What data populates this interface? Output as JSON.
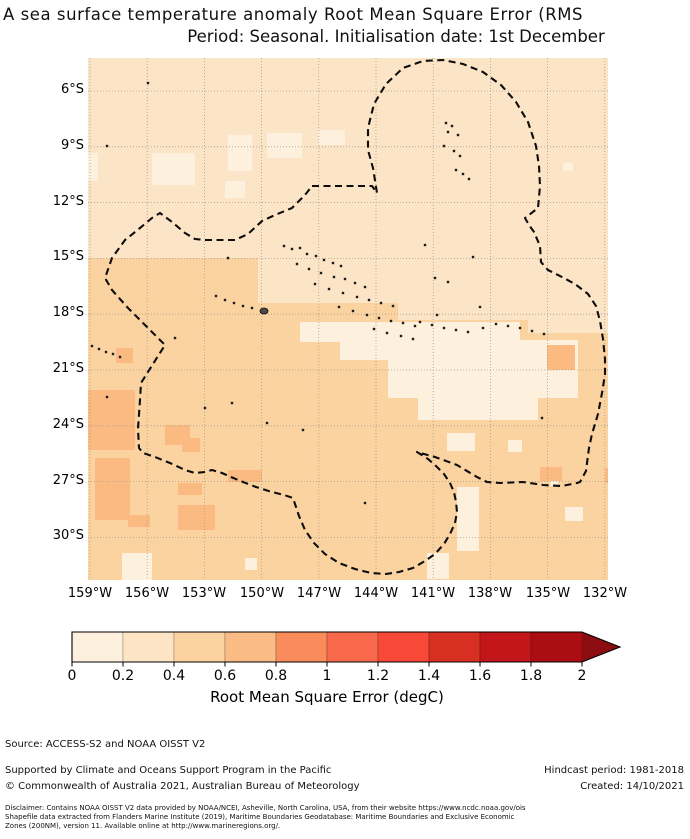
{
  "title": {
    "line1": "A sea surface temperature anomaly Root Mean Square Error (RMS",
    "line2": "Period: Seasonal. Initialisation date: 1st December"
  },
  "axes": {
    "y": [
      {
        "label": "6°S",
        "y": 91
      },
      {
        "label": "9°S",
        "y": 147
      },
      {
        "label": "12°S",
        "y": 203
      },
      {
        "label": "15°S",
        "y": 258
      },
      {
        "label": "18°S",
        "y": 314
      },
      {
        "label": "21°S",
        "y": 370
      },
      {
        "label": "24°S",
        "y": 426
      },
      {
        "label": "27°S",
        "y": 482
      },
      {
        "label": "30°S",
        "y": 537
      }
    ],
    "x": [
      {
        "label": "159°W",
        "x": 90
      },
      {
        "label": "156°W",
        "x": 147
      },
      {
        "label": "153°W",
        "x": 204
      },
      {
        "label": "150°W",
        "x": 262
      },
      {
        "label": "147°W",
        "x": 319
      },
      {
        "label": "144°W",
        "x": 376
      },
      {
        "label": "141°W",
        "x": 433
      },
      {
        "label": "138°W",
        "x": 490
      },
      {
        "label": "135°W",
        "x": 548
      },
      {
        "label": "132°W",
        "x": 605
      }
    ]
  },
  "colorbar": {
    "x": 72,
    "y": 2,
    "width": 510,
    "height": 30,
    "tip_x": 620,
    "segment_colors": [
      "#fdf0dc",
      "#fce4c4",
      "#fcd3a0",
      "#fbbb84",
      "#fa8c5c",
      "#f8684a",
      "#f74838",
      "#d72f21",
      "#c2161b",
      "#aa0e13"
    ],
    "arrow_color": "#8b0d11",
    "tick_labels": [
      "0",
      "0.2",
      "0.4",
      "0.6",
      "0.8",
      "1",
      "1.2",
      "1.4",
      "1.6",
      "1.8",
      "2"
    ],
    "label": "Root Mean Square Error (degC)"
  },
  "map": {
    "width": 520,
    "height": 522,
    "colors": {
      "base_north": "#fce4c6",
      "base_south": "#fbd3a1",
      "pale": "#fdf0dd",
      "dark": "#fbba82",
      "island": "#1c1c1c",
      "tahiti": "#4a4a4a",
      "grid": "#aa9d8b",
      "eez": "#0d0d0d"
    },
    "grid": {
      "vx": [
        2,
        59.2,
        116.4,
        173.6,
        230.8,
        288,
        345.2,
        402.4,
        459.6,
        516.8
      ],
      "hy": [
        33,
        88.8,
        144.6,
        200.4,
        256.2,
        312,
        367.8,
        423.6,
        479.4
      ]
    },
    "south_rects": [
      [
        0,
        200,
        170,
        322
      ],
      [
        170,
        245,
        140,
        277
      ],
      [
        310,
        262,
        130,
        260
      ],
      [
        440,
        275,
        80,
        247
      ]
    ],
    "pale_rects": [
      [
        64,
        95,
        43,
        32
      ],
      [
        140,
        77,
        24,
        36
      ],
      [
        179,
        75,
        35,
        25
      ],
      [
        230,
        72,
        27,
        15
      ],
      [
        137,
        123,
        20,
        17
      ],
      [
        0,
        95,
        10,
        28
      ],
      [
        212,
        264,
        46,
        20
      ],
      [
        252,
        264,
        180,
        38
      ],
      [
        300,
        282,
        190,
        58
      ],
      [
        330,
        330,
        120,
        32
      ],
      [
        369,
        429,
        22,
        64
      ],
      [
        359,
        375,
        28,
        18
      ],
      [
        420,
        382,
        14,
        12
      ],
      [
        477,
        449,
        18,
        14
      ],
      [
        339,
        495,
        22,
        26
      ],
      [
        34,
        495,
        30,
        27
      ],
      [
        157,
        500,
        12,
        12
      ],
      [
        462,
        422,
        8,
        6
      ],
      [
        475,
        105,
        10,
        8
      ]
    ],
    "dark_rects": [
      [
        0,
        332,
        47,
        60
      ],
      [
        7,
        400,
        35,
        62
      ],
      [
        90,
        425,
        24,
        12
      ],
      [
        90,
        447,
        37,
        25
      ],
      [
        40,
        457,
        22,
        12
      ],
      [
        77,
        367,
        25,
        20
      ],
      [
        140,
        412,
        34,
        12
      ],
      [
        452,
        409,
        22,
        14
      ],
      [
        459,
        287,
        28,
        25
      ],
      [
        94,
        380,
        18,
        14
      ],
      [
        28,
        290,
        17,
        15
      ],
      [
        517,
        410,
        3,
        15
      ]
    ],
    "eez_path": "M224,128 L284,128 L289,135 L285,110 L280,92 L280,70 L286,46 L298,26 L315,10 L335,3 L355,2 L375,6 L395,14 L413,27 L428,44 L440,64 L448,88 L451,108 L452,128 L450,150 L437,160 L441,167 L446,174 L452,188 L453,204 L460,212 L472,218 L487,226 L500,236 L508,248 L512,263 L515,281 L517,301 L517,316 L514,335 L510,356 L504,376 L501,390 L499,405 L498,413 L492,424 L489,425 L474,428 L455,427 L435,424 L412,425 L399,424 L389,419 L369,407 L347,399 L329,394 L340,401 L348,408 L356,416 L362,425 L366,434 L368,444 L369,454 L367,465 L362,476 L356,486 L347,496 L337,503 L325,510 L311,514 L298,516 L283,515 L267,511 L251,505 L237,496 L226,485 L217,472 L211,458 L207,446 L205,440 L196,437 L184,434 L168,429 L155,424 L143,419 L134,415 L124,412 L117,414 L107,415 L97,412 L82,405 L67,399 L55,395 L51,390 L50,371 L52,342 L53,325 L77,287 L52,262 L40,250 L24,232 L17,220 L24,200 L37,182 L52,170 L64,160 L72,155 L84,164 L97,175 L107,181 L117,182 L132,182 L147,182 L160,176 L174,163 L187,157 L204,150 L217,137 Z",
    "islands": [
      [
        60,
        25
      ],
      [
        19,
        88
      ],
      [
        140,
        200
      ],
      [
        358,
        65
      ],
      [
        364,
        68
      ],
      [
        360,
        74
      ],
      [
        370,
        77
      ],
      [
        356,
        88
      ],
      [
        366,
        93
      ],
      [
        372,
        98
      ],
      [
        368,
        112
      ],
      [
        375,
        116
      ],
      [
        381,
        121
      ],
      [
        196,
        188
      ],
      [
        204,
        191
      ],
      [
        212,
        190
      ],
      [
        219,
        196
      ],
      [
        228,
        198
      ],
      [
        236,
        202
      ],
      [
        245,
        205
      ],
      [
        253,
        208
      ],
      [
        209,
        206
      ],
      [
        221,
        211
      ],
      [
        233,
        215
      ],
      [
        246,
        219
      ],
      [
        257,
        221
      ],
      [
        267,
        225
      ],
      [
        277,
        229
      ],
      [
        227,
        226
      ],
      [
        241,
        231
      ],
      [
        255,
        235
      ],
      [
        269,
        239
      ],
      [
        281,
        242
      ],
      [
        293,
        245
      ],
      [
        305,
        248
      ],
      [
        251,
        249
      ],
      [
        265,
        253
      ],
      [
        279,
        257
      ],
      [
        291,
        260
      ],
      [
        303,
        263
      ],
      [
        315,
        265
      ],
      [
        327,
        268
      ],
      [
        286,
        271
      ],
      [
        299,
        275
      ],
      [
        313,
        278
      ],
      [
        325,
        281
      ],
      [
        337,
        187
      ],
      [
        385,
        199
      ],
      [
        347,
        220
      ],
      [
        360,
        224
      ],
      [
        349,
        257
      ],
      [
        392,
        249
      ],
      [
        128,
        238
      ],
      [
        137,
        242
      ],
      [
        146,
        245
      ],
      [
        155,
        248
      ],
      [
        164,
        250
      ],
      [
        4,
        288
      ],
      [
        11,
        291
      ],
      [
        18,
        294
      ],
      [
        25,
        296
      ],
      [
        32,
        299
      ],
      [
        332,
        264
      ],
      [
        344,
        267
      ],
      [
        356,
        270
      ],
      [
        368,
        272
      ],
      [
        380,
        274
      ],
      [
        395,
        270
      ],
      [
        408,
        266
      ],
      [
        420,
        268
      ],
      [
        432,
        270
      ],
      [
        444,
        273
      ],
      [
        456,
        276
      ],
      [
        117,
        350
      ],
      [
        144,
        345
      ],
      [
        179,
        365
      ],
      [
        215,
        372
      ],
      [
        19,
        339
      ],
      [
        87,
        280
      ],
      [
        454,
        360
      ],
      [
        277,
        445
      ]
    ],
    "tahiti": [
      176,
      253
    ]
  },
  "footer": {
    "source": "Source: ACCESS-S2 and NOAA OISST V2",
    "supported": "Supported by Climate and Oceans Support Program in the Pacific",
    "copyright": "© Commonwealth of Australia 2021, Australian Bureau of Meteorology",
    "hindcast": "Hindcast period: 1981-2018",
    "created": "Created: 14/10/2021",
    "disclaimer1": "Disclaimer: Contains NOAA OISST V2 data provided by NOAA/NCEI, Asheville, North Carolina, USA, from their website https://www.ncdc.noaa.gov/ois",
    "disclaimer2": "Shapefile data extracted from Flanders Marine Institute (2019), Maritime Boundaries Geodatabase: Maritime Boundaries and Exclusive Economic",
    "disclaimer3": "Zones (200NM), version 11. Available online at http://www.marineregions.org/."
  }
}
